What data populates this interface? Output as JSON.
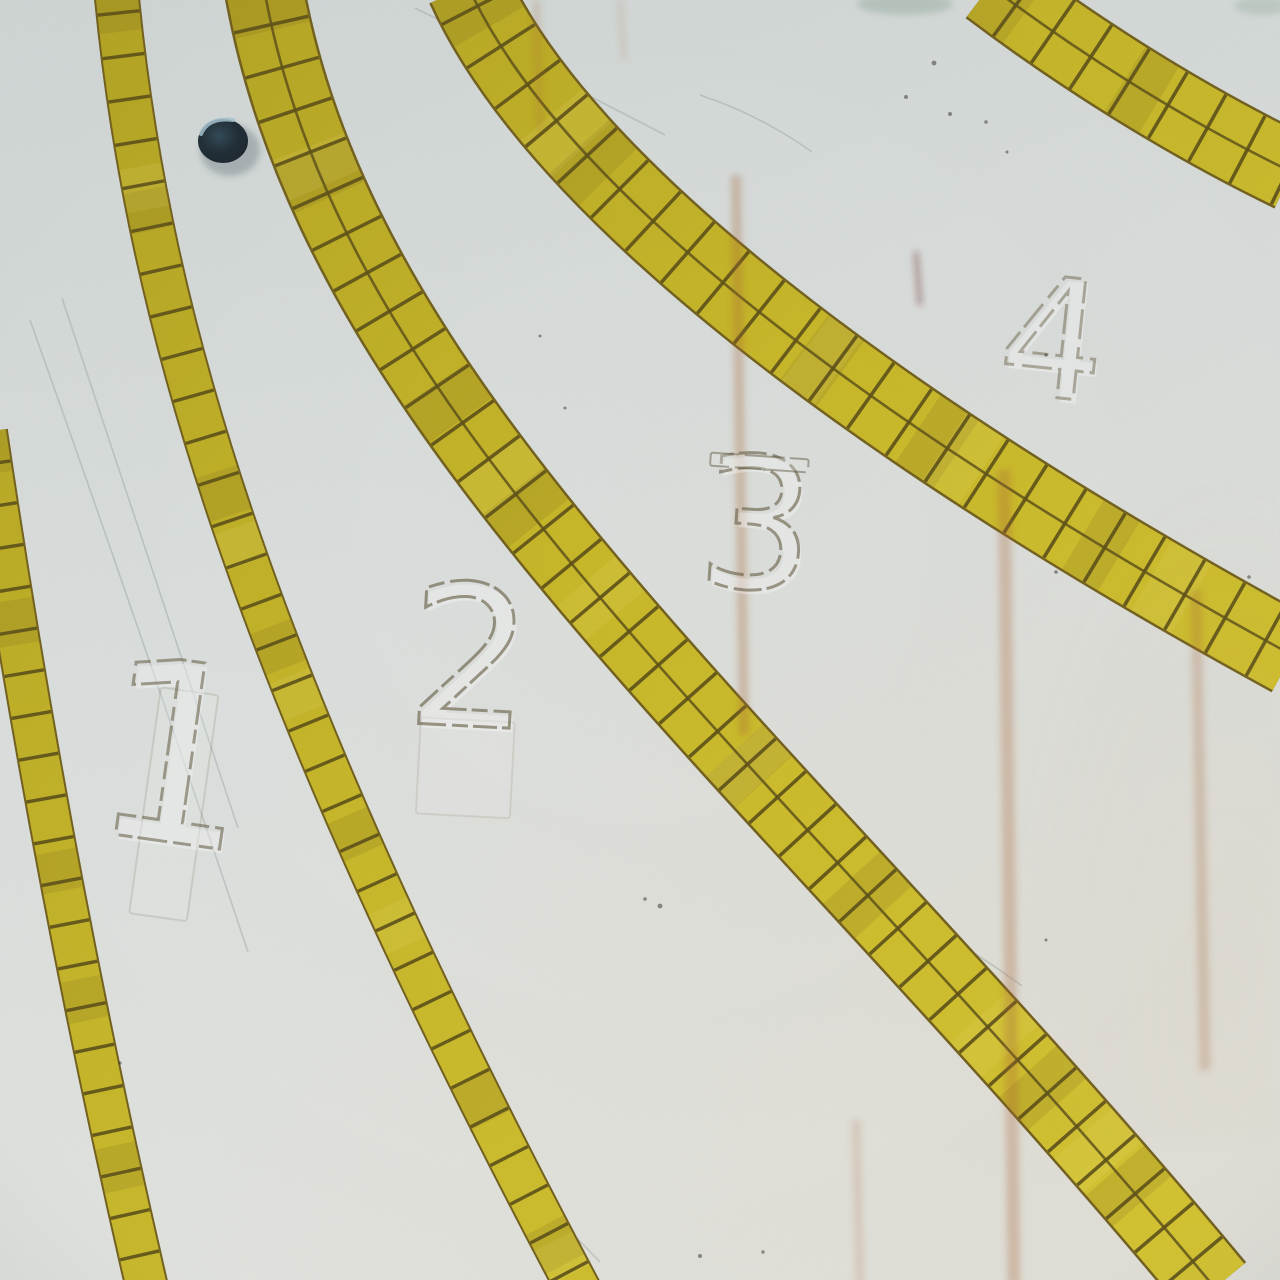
{
  "scene": {
    "description": "Overhead photograph of a weathered white water-slide / pool floor with four numbered racing lanes divided by curved yellow mosaic-tile stripes, a small dark drain hole near the top left, rust streaks and scratches on the concrete surface",
    "lane_count": 4,
    "tile_stripe_count": 5,
    "drain_hole": "small dark round hole near top left"
  },
  "lanes": [
    {
      "label": "1"
    },
    {
      "label": "2"
    },
    {
      "label": "3"
    },
    {
      "label": "4"
    }
  ],
  "colors": {
    "surface_top": "#d3d9d8",
    "surface_bottom": "#e7e8e3",
    "tile_dark": "#b2a117",
    "tile_bright": "#d9c627",
    "grout": "#584a0c",
    "band_edge": "#6e5a12",
    "rust": "#a8612f",
    "hole_fill": "#16232d",
    "hole_rim": "#a8c4d4",
    "digit_stroke": "#5a5034"
  }
}
